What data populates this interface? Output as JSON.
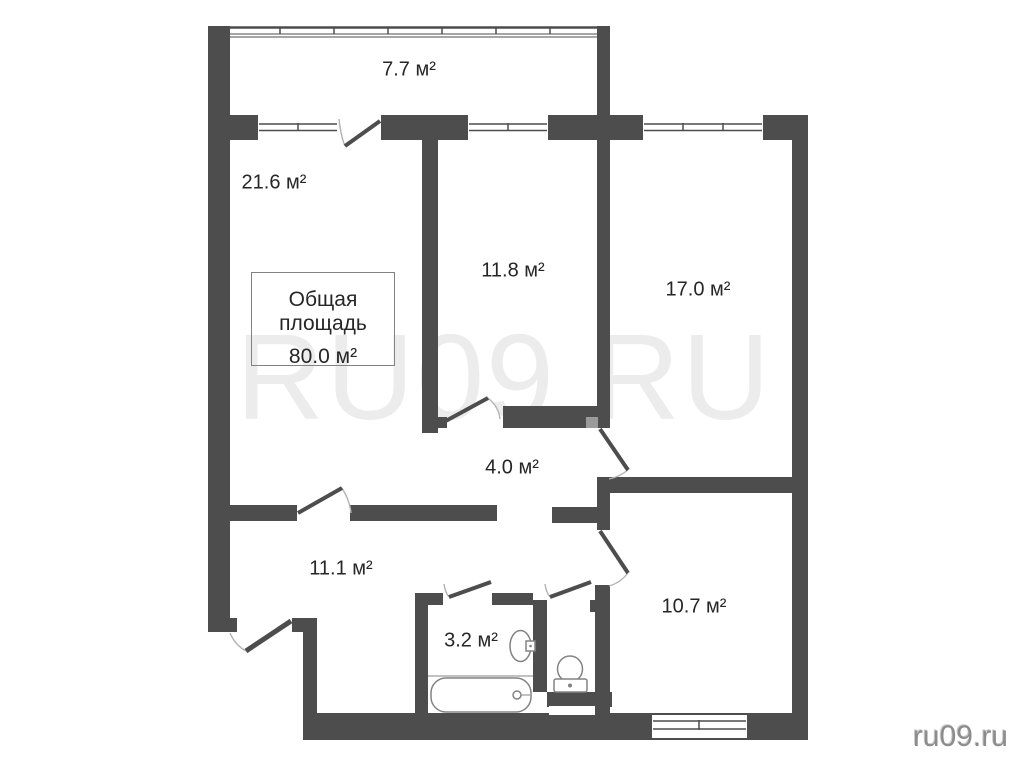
{
  "plan": {
    "type": "apartment-floor-plan",
    "rooms": [
      {
        "id": "balcony",
        "area": "7.7 м²"
      },
      {
        "id": "living-room",
        "area": "21.6 м²"
      },
      {
        "id": "bedroom-middle",
        "area": "11.8 м²"
      },
      {
        "id": "bedroom-right",
        "area": "17.0 м²"
      },
      {
        "id": "hallway",
        "area": "4.0 м²"
      },
      {
        "id": "entrance-hall",
        "area": "11.1 м²"
      },
      {
        "id": "bathroom",
        "area": "3.2 м²"
      },
      {
        "id": "bedroom-bottom",
        "area": "10.7 м²"
      }
    ],
    "total_area_box": {
      "title": "Общая площадь",
      "value": "80.0 м²"
    }
  },
  "watermark": {
    "text": "RU09.RU",
    "color": "#ececec"
  },
  "site_credit": {
    "text": "ru09.ru",
    "color": "#8c8c8c"
  },
  "colors": {
    "wall": "#4d4d4d",
    "door-hinge-marker": "#9b9b9b",
    "door-arc": "#b3b3b3",
    "fixture-outline": "#838383",
    "label-text": "#262626",
    "background": "#ffffff"
  }
}
